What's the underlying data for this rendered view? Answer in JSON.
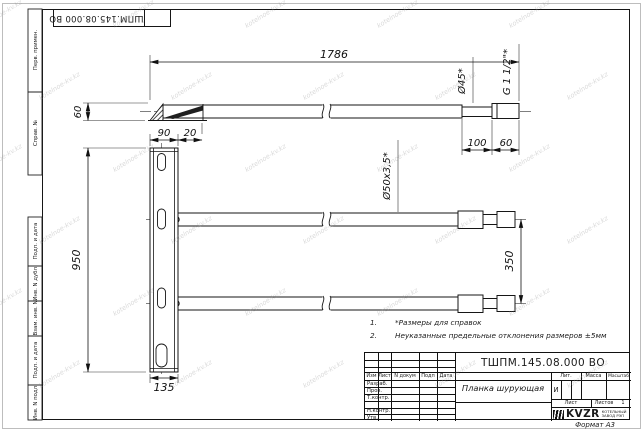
{
  "watermark": {
    "text": "kotelnoe-kv.kz"
  },
  "sheet": {
    "designation": "ТШПМ.145.08.000 ВО",
    "format_label": "Формат А3"
  },
  "margin_labels": {
    "perv": "Перв. примен.",
    "sprav": "Справ. №",
    "podp1": "Подп. и дата",
    "inv_dubl": "Инв. N дубл.",
    "vzam": "Взам. инв. N",
    "podp2": "Подп. и дата",
    "inv_podl": "Инв. N подл."
  },
  "dims": {
    "length": "1786",
    "height": "950",
    "width": "135",
    "top_w": "90",
    "tip": "20",
    "tip_h": "60",
    "pipe": "Ø50x3,5*",
    "neck": "Ø45*",
    "thread": "G 1 1/2\"*",
    "neck_len": "100",
    "end_len": "60",
    "spacing": "350"
  },
  "notes": {
    "n1_num": "1.",
    "n1_text": "*Размеры для справок",
    "n2_num": "2.",
    "n2_text": "Неуказанные предельные отклонения размеров ±5мм"
  },
  "title_block": {
    "designation": "ТШПМ.145.08.000 ВО",
    "part_name": "Планка шурующая",
    "cols": {
      "izm": "Изм",
      "list": "Лист",
      "doc": "N докум",
      "podp": "Подп",
      "data": "Дата"
    },
    "rows": {
      "razrab": "Разраб.",
      "prov": "Пров.",
      "tkontr": "Т.контр.",
      "nkontr": "Н.контр.",
      "utv": "Утв."
    },
    "right": {
      "lit": "Лит.",
      "massa": "Масса",
      "masshtab": "Масштаб",
      "lit_value": "И",
      "list": "Лист",
      "listov": "Листов",
      "listov_value": "1"
    },
    "logo": {
      "name": "KVZR",
      "line1": "КОТЕЛЬНЫЙ",
      "line2": "ЗАВОД РЭП"
    }
  }
}
